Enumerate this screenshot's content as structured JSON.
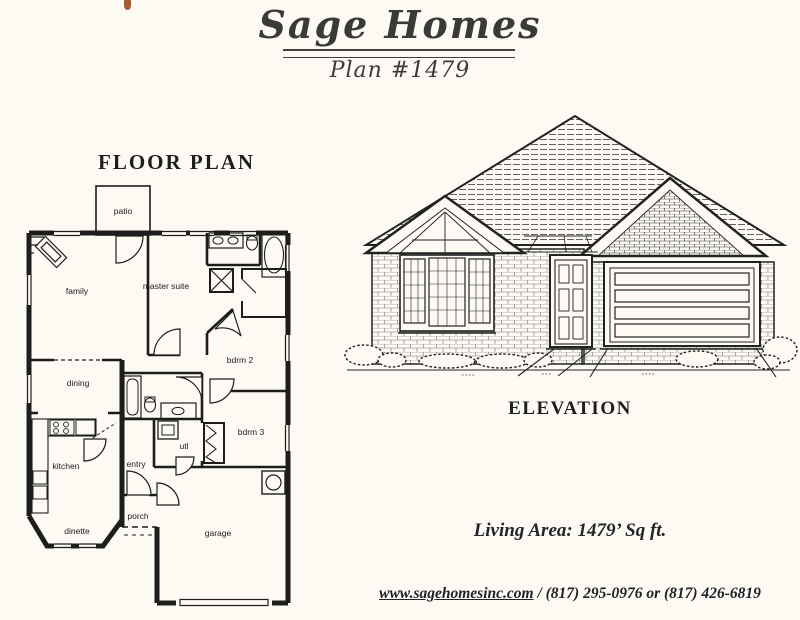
{
  "page": {
    "background_color": "#fcfaf2",
    "ink_color": "#262626",
    "scan_artifact_color": "#a8593a"
  },
  "header": {
    "title": "Sage Homes",
    "subtitle": "Plan #1479"
  },
  "floor_plan": {
    "heading": "FLOOR PLAN",
    "rooms": {
      "patio": "patio",
      "family": "family",
      "master_suite": "master suite",
      "dining": "dining",
      "bdrm2": "bdrm 2",
      "bdrm3": "bdrm 3",
      "kitchen": "kitchen",
      "entry": "entry",
      "utl": "utl",
      "dinette": "dinette",
      "porch": "porch",
      "garage": "garage"
    }
  },
  "elevation": {
    "heading": "ELEVATION"
  },
  "details": {
    "living_area": "Living Area:  1479’ Sq ft."
  },
  "footer": {
    "website": "www.sagehomesinc.com",
    "phones": " / (817) 295-0976 or (817) 426-6819"
  }
}
